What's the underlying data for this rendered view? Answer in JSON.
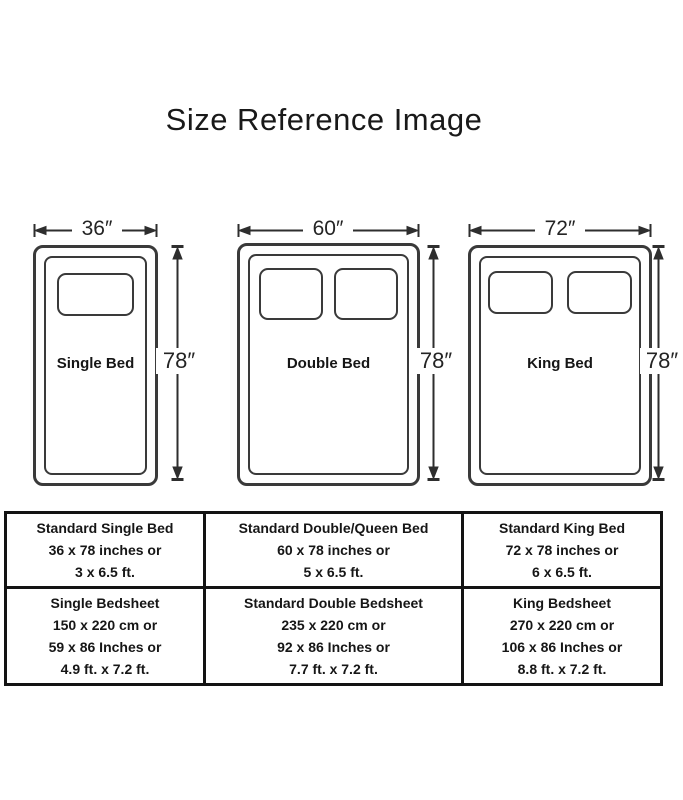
{
  "title": "Size Reference Image",
  "beds": [
    {
      "name": "Single Bed",
      "width_label": "36″",
      "height_label": "78″"
    },
    {
      "name": "Double Bed",
      "width_label": "60″",
      "height_label": "78″"
    },
    {
      "name": "King Bed",
      "width_label": "72″",
      "height_label": "78″"
    }
  ],
  "table": {
    "rows": [
      [
        {
          "lines": [
            "Standard Single Bed",
            "36 x 78 inches or",
            "3 x 6.5 ft."
          ]
        },
        {
          "lines": [
            "Standard Double/Queen Bed",
            "60 x 78 inches or",
            "5 x 6.5 ft."
          ]
        },
        {
          "lines": [
            "Standard King Bed",
            "72 x 78 inches or",
            "6 x 6.5 ft."
          ]
        }
      ],
      [
        {
          "lines": [
            "Single Bedsheet",
            "150 x 220 cm or",
            "59 x 86 Inches or",
            "4.9 ft. x 7.2 ft."
          ]
        },
        {
          "lines": [
            "Standard Double Bedsheet",
            "235 x 220 cm or",
            "92 x 86 Inches or",
            "7.7 ft. x 7.2 ft."
          ]
        },
        {
          "lines": [
            "King Bedsheet",
            "270 x 220 cm or",
            "106 x 86 Inches or",
            "8.8 ft. x 7.2 ft."
          ]
        }
      ]
    ]
  },
  "colors": {
    "background": "#ffffff",
    "line": "#3a3a3a",
    "arrow": "#2e2e2e",
    "table_border": "#131313",
    "text": "#1a1a1a"
  }
}
